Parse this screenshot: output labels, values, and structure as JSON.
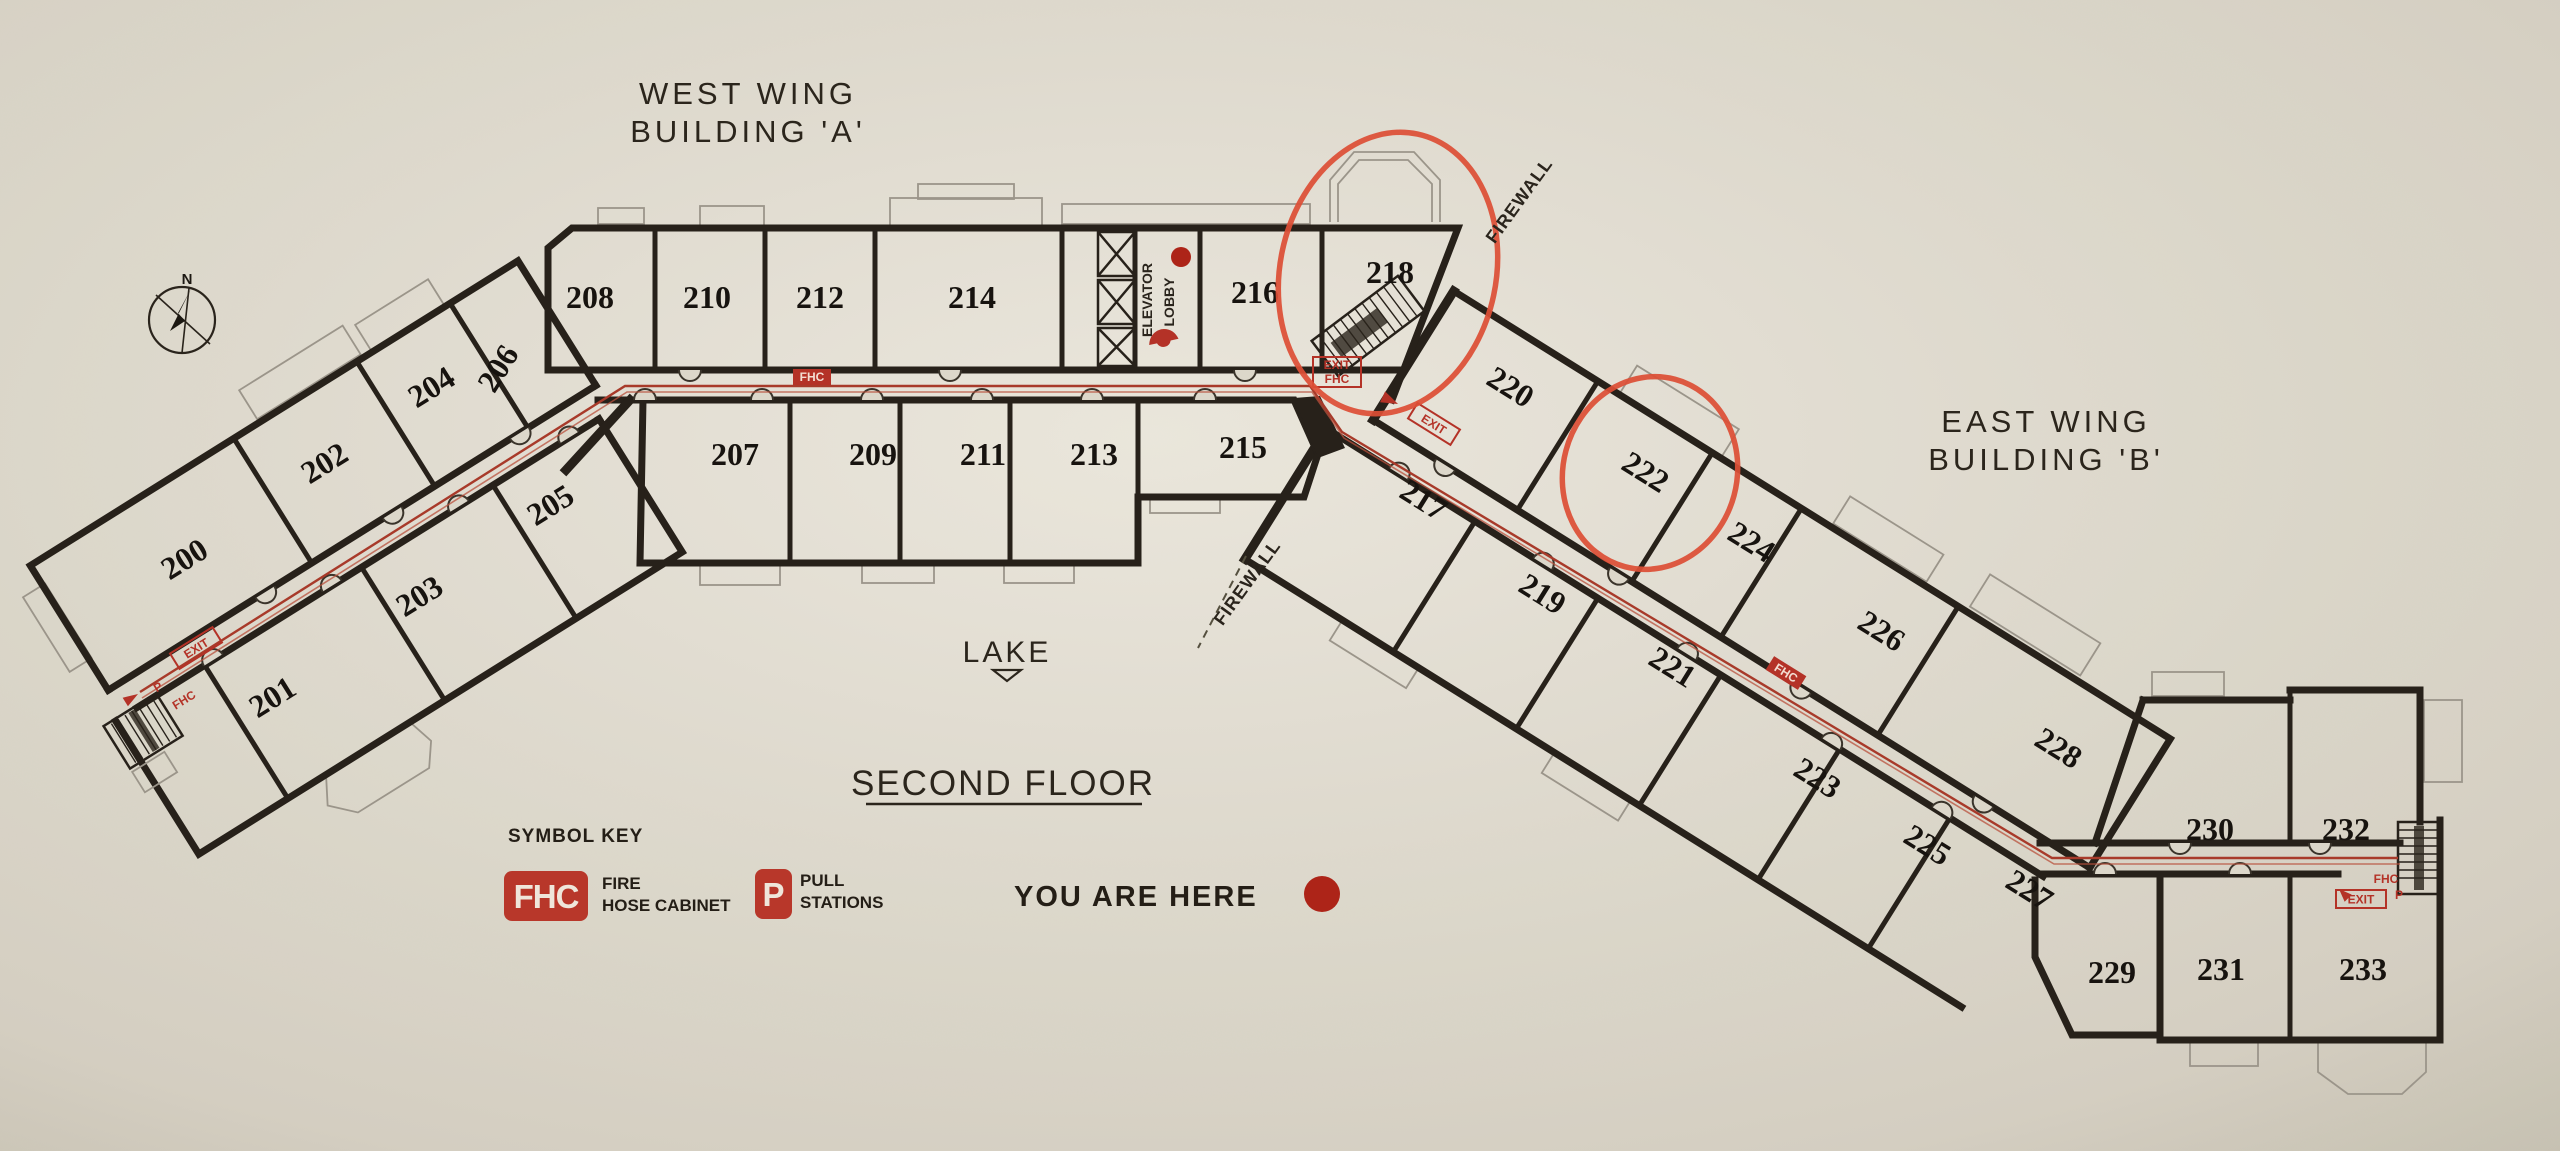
{
  "palette": {
    "paper": "#dcd7ca",
    "wall": "#27211a",
    "marker_red": "#b43227",
    "circle_red": "#dd4f36",
    "route_red": "#a83a2a",
    "legend_red": "#b8372a",
    "dot_red": "#ad2418"
  },
  "titles": {
    "west_wing_line1": "WEST WING",
    "west_wing_line2": "BUILDING 'A'",
    "east_wing_line1": "EAST WING",
    "east_wing_line2": "BUILDING 'B'",
    "floor_title": "SECOND FLOOR",
    "lake_label": "LAKE",
    "compass_north": "N"
  },
  "legend": {
    "heading": "SYMBOL KEY",
    "fhc_symbol": "FHC",
    "fhc_desc_line1": "FIRE",
    "fhc_desc_line2": "HOSE CABINET",
    "pull_symbol": "P",
    "pull_desc_line1": "PULL",
    "pull_desc_line2": "STATIONS",
    "you_are_here_label": "YOU ARE HERE"
  },
  "plan_labels": {
    "elevator_lobby_line1": "ELEVATOR",
    "elevator_lobby_line2": "LOBBY",
    "firewall_upper": "FIREWALL",
    "firewall_lower": "FIREWALL"
  },
  "annotations": {
    "circled_rooms": [
      "218",
      "222"
    ]
  },
  "rooms": [
    {
      "number": "200",
      "x": 190,
      "y": 568,
      "rot": -32
    },
    {
      "number": "201",
      "x": 278,
      "y": 706,
      "rot": -32
    },
    {
      "number": "202",
      "x": 330,
      "y": 472,
      "rot": -32
    },
    {
      "number": "203",
      "x": 425,
      "y": 605,
      "rot": -32
    },
    {
      "number": "204",
      "x": 437,
      "y": 396,
      "rot": -32
    },
    {
      "number": "205",
      "x": 556,
      "y": 514,
      "rot": -32
    },
    {
      "number": "206",
      "x": 507,
      "y": 374,
      "rot": -58
    },
    {
      "number": "207",
      "x": 735,
      "y": 465,
      "rot": 0
    },
    {
      "number": "208",
      "x": 590,
      "y": 308,
      "rot": 0
    },
    {
      "number": "209",
      "x": 873,
      "y": 465,
      "rot": 0
    },
    {
      "number": "210",
      "x": 707,
      "y": 308,
      "rot": 0
    },
    {
      "number": "211",
      "x": 983,
      "y": 465,
      "rot": 0
    },
    {
      "number": "212",
      "x": 820,
      "y": 308,
      "rot": 0
    },
    {
      "number": "213",
      "x": 1094,
      "y": 465,
      "rot": 0
    },
    {
      "number": "214",
      "x": 972,
      "y": 308,
      "rot": 0
    },
    {
      "number": "215",
      "x": 1243,
      "y": 458,
      "rot": 0
    },
    {
      "number": "216",
      "x": 1255,
      "y": 303,
      "rot": 0
    },
    {
      "number": "217",
      "x": 1418,
      "y": 509,
      "rot": 32
    },
    {
      "number": "218",
      "x": 1390,
      "y": 283,
      "rot": 0
    },
    {
      "number": "219",
      "x": 1537,
      "y": 603,
      "rot": 32
    },
    {
      "number": "220",
      "x": 1505,
      "y": 396,
      "rot": 32
    },
    {
      "number": "221",
      "x": 1667,
      "y": 676,
      "rot": 32
    },
    {
      "number": "222",
      "x": 1640,
      "y": 481,
      "rot": 32
    },
    {
      "number": "223",
      "x": 1812,
      "y": 787,
      "rot": 32
    },
    {
      "number": "224",
      "x": 1746,
      "y": 551,
      "rot": 32
    },
    {
      "number": "225",
      "x": 1922,
      "y": 854,
      "rot": 32
    },
    {
      "number": "226",
      "x": 1876,
      "y": 640,
      "rot": 32
    },
    {
      "number": "227",
      "x": 2024,
      "y": 899,
      "rot": 32
    },
    {
      "number": "228",
      "x": 2053,
      "y": 757,
      "rot": 32
    },
    {
      "number": "229",
      "x": 2112,
      "y": 983,
      "rot": 0
    },
    {
      "number": "230",
      "x": 2210,
      "y": 840,
      "rot": 0
    },
    {
      "number": "231",
      "x": 2221,
      "y": 980,
      "rot": 0
    },
    {
      "number": "232",
      "x": 2346,
      "y": 840,
      "rot": 0
    },
    {
      "number": "233",
      "x": 2363,
      "y": 980,
      "rot": 0
    }
  ],
  "route_markers": [
    {
      "text": "FHC",
      "x": 812,
      "y": 377,
      "rot": 0,
      "style": "fill"
    },
    {
      "text": "EXIT",
      "second": "FHC",
      "x": 1337,
      "y": 372,
      "rot": 0,
      "style": "outline2"
    },
    {
      "text": "EXIT",
      "x": 1434,
      "y": 424,
      "rot": 32,
      "style": "outline"
    },
    {
      "text": "FHC",
      "x": 1786,
      "y": 673,
      "rot": 32,
      "style": "fill"
    },
    {
      "text": "EXIT",
      "x": 196,
      "y": 648,
      "rot": -32,
      "style": "outline"
    },
    {
      "text": "P",
      "x": 158,
      "y": 687,
      "rot": -32,
      "style": "plain"
    },
    {
      "text": "FHC",
      "x": 184,
      "y": 700,
      "rot": -32,
      "style": "plain"
    },
    {
      "text": "FHC",
      "x": 2386,
      "y": 879,
      "rot": 0,
      "style": "plain"
    },
    {
      "text": "P",
      "x": 2399,
      "y": 895,
      "rot": 0,
      "style": "plain"
    },
    {
      "text": "EXIT",
      "x": 2361,
      "y": 899,
      "rot": 0,
      "style": "outline"
    }
  ]
}
